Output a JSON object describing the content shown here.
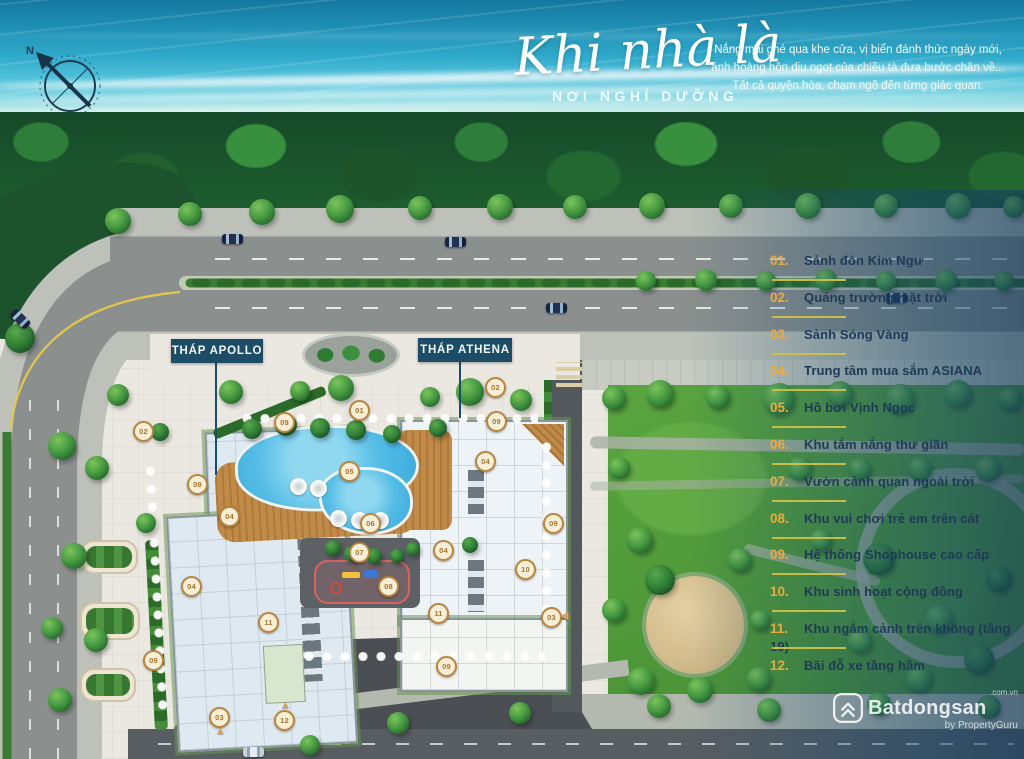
{
  "header": {
    "title_script": "Khi nhà là",
    "title_caps": "NƠI NGHỈ DƯỠNG",
    "tagline": "Nắng mai ghé qua khe cửa, vị biển đánh thức ngày mới,\nánh hoàng hôn dịu ngọt của chiều tà đưa bước chân về...\nTất cả quyện hòa, chạm ngõ đến từng giác quan.",
    "compass_label": "N"
  },
  "towers": {
    "apollo": "THÁP APOLLO",
    "athena": "THÁP ATHENA"
  },
  "legend": {
    "items": [
      {
        "num": "01.",
        "label": "Sảnh đón Kim Ngư"
      },
      {
        "num": "02.",
        "label": "Quảng trường mặt trời"
      },
      {
        "num": "03.",
        "label": "Sảnh Sóng Vàng"
      },
      {
        "num": "04.",
        "label": "Trung tâm mua sắm ASIANA"
      },
      {
        "num": "05.",
        "label": "Hồ bơi Vịnh Ngọc"
      },
      {
        "num": "06.",
        "label": "Khu tắm nắng thư giãn"
      },
      {
        "num": "07.",
        "label": "Vườn cảnh quan ngoài trời"
      },
      {
        "num": "08.",
        "label": "Khu vui chơi trẻ em trên cát"
      },
      {
        "num": "09.",
        "label": "Hệ thống Shophouse cao cấp"
      },
      {
        "num": "10.",
        "label": "Khu sinh hoạt cộng đồng"
      },
      {
        "num": "11.",
        "label": "Khu ngắm cảnh trên không (tầng 19)"
      },
      {
        "num": "12.",
        "label": "Bãi đỗ xe tầng hầm"
      }
    ]
  },
  "map_markers": [
    {
      "n": "01",
      "x": 358,
      "y": 409
    },
    {
      "n": "02",
      "x": 142,
      "y": 430
    },
    {
      "n": "02",
      "x": 494,
      "y": 386
    },
    {
      "n": "03",
      "x": 218,
      "y": 716
    },
    {
      "n": "03",
      "x": 550,
      "y": 616
    },
    {
      "n": "04",
      "x": 228,
      "y": 515
    },
    {
      "n": "04",
      "x": 190,
      "y": 585
    },
    {
      "n": "04",
      "x": 484,
      "y": 460
    },
    {
      "n": "04",
      "x": 442,
      "y": 549
    },
    {
      "n": "05",
      "x": 348,
      "y": 470
    },
    {
      "n": "06",
      "x": 369,
      "y": 522
    },
    {
      "n": "07",
      "x": 358,
      "y": 551
    },
    {
      "n": "08",
      "x": 387,
      "y": 585
    },
    {
      "n": "09",
      "x": 283,
      "y": 421
    },
    {
      "n": "09",
      "x": 495,
      "y": 420
    },
    {
      "n": "09",
      "x": 196,
      "y": 483
    },
    {
      "n": "09",
      "x": 152,
      "y": 659
    },
    {
      "n": "09",
      "x": 445,
      "y": 665
    },
    {
      "n": "09",
      "x": 552,
      "y": 522
    },
    {
      "n": "10",
      "x": 524,
      "y": 568
    },
    {
      "n": "11",
      "x": 267,
      "y": 621
    },
    {
      "n": "11",
      "x": 437,
      "y": 612
    },
    {
      "n": "12",
      "x": 283,
      "y": 719
    }
  ],
  "watermark": {
    "brand": "Batdongsan",
    "domain": ".com.vn",
    "byline": "by PropertyGuru"
  },
  "colors": {
    "accent_gold": "#EDAA3C",
    "label_navy": "#1C4C66",
    "legend_text": "#1E3A56",
    "underline_yellow": "#CDC048",
    "pool_blue": "#3AA9DC"
  }
}
